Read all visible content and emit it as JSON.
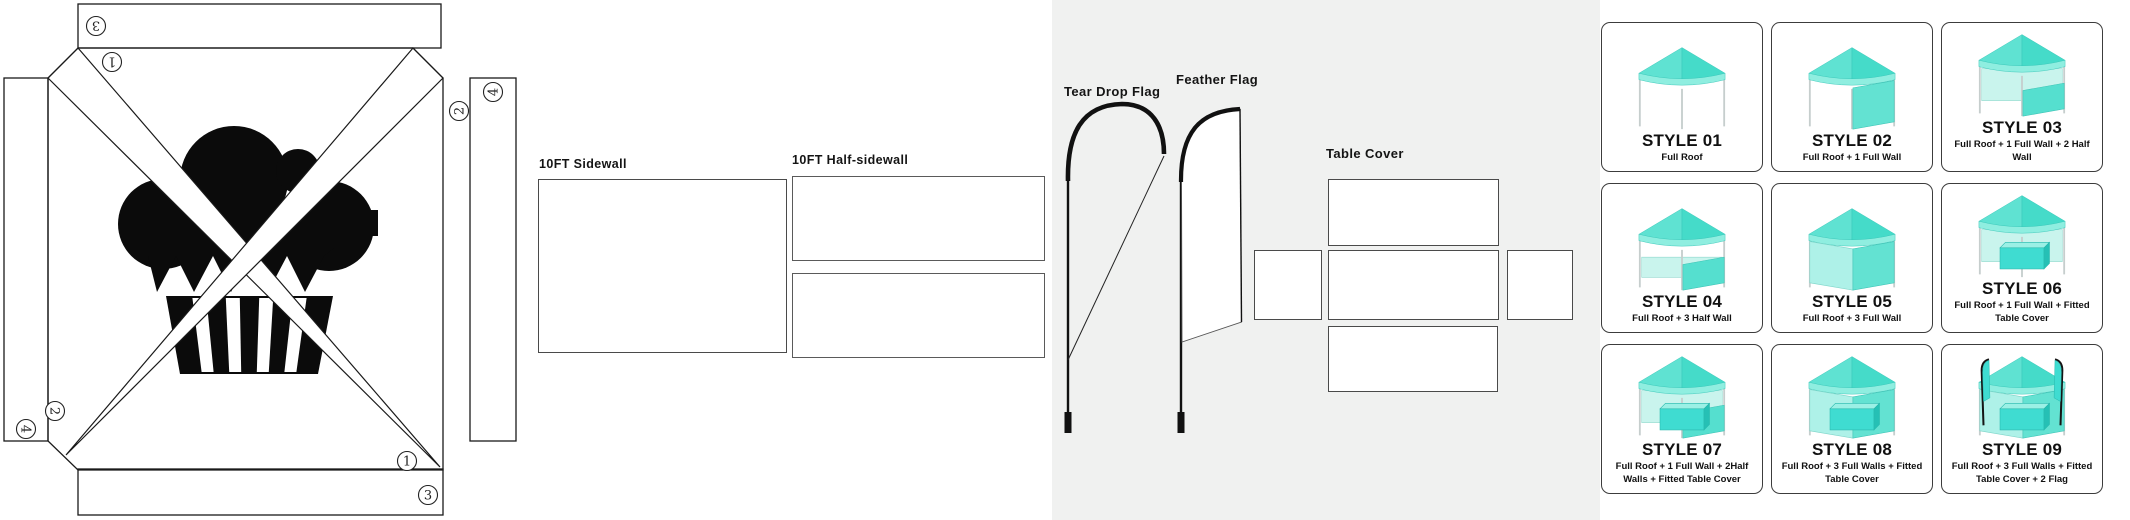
{
  "colors": {
    "ink": "#1a1a1a",
    "logo_black": "#0b0b0b",
    "tent_teal_main": "#4fdccb",
    "tent_teal_light": "#8feee0",
    "tent_teal_pale": "#c9f4ed",
    "card_border": "#3c3c3c",
    "zone_bg": "#f0f1f0"
  },
  "canopy_template": {
    "numbers": {
      "top_strip": "3",
      "top_panel": "1",
      "right_strip": "4",
      "right_panel": "2",
      "left_strip": "4",
      "left_panel": "2",
      "bottom_panel": "1",
      "bottom_strip": "3"
    }
  },
  "sidewalls": {
    "sidewall_label": "10FT Sidewall",
    "half_sidewall_label": "10FT Half-sidewall"
  },
  "flags": {
    "teardrop_label": "Tear Drop Flag",
    "feather_label": "Feather Flag"
  },
  "table_cover": {
    "label": "Table Cover"
  },
  "styles_grid": {
    "cards": [
      {
        "title": "STYLE 01",
        "desc": "Full Roof",
        "layers": []
      },
      {
        "title": "STYLE 02",
        "desc": "Full Roof + 1 Full Wall",
        "layers": [
          "rightFull"
        ]
      },
      {
        "title": "STYLE 03",
        "desc": "Full Roof + 1 Full Wall + 2 Half Wall",
        "layers": [
          "backFull",
          "rightHalf"
        ]
      },
      {
        "title": "STYLE 04",
        "desc": "Full Roof + 3 Half Wall",
        "layers": [
          "backHalf",
          "rightHalf"
        ]
      },
      {
        "title": "STYLE 05",
        "desc": "Full Roof + 3 Full Wall",
        "layers": [
          "leftFull",
          "rightFull"
        ]
      },
      {
        "title": "STYLE 06",
        "desc": "Full Roof + 1 Full Wall + Fitted Table Cover",
        "layers": [
          "backFull",
          "table"
        ]
      },
      {
        "title": "STYLE 07",
        "desc": "Full Roof + 1 Full Wall + 2Half Walls + Fitted Table Cover",
        "layers": [
          "backFull",
          "rightHalf",
          "table"
        ]
      },
      {
        "title": "STYLE 08",
        "desc": "Full Roof + 3 Full Walls + Fitted Table Cover",
        "layers": [
          "leftFull",
          "rightFull",
          "table"
        ]
      },
      {
        "title": "STYLE 09",
        "desc": "Full Roof + 3 Full Walls + Fitted Table Cover + 2 Flag",
        "layers": [
          "leftFull",
          "rightFull",
          "table",
          "flagL",
          "flagR"
        ]
      }
    ]
  }
}
